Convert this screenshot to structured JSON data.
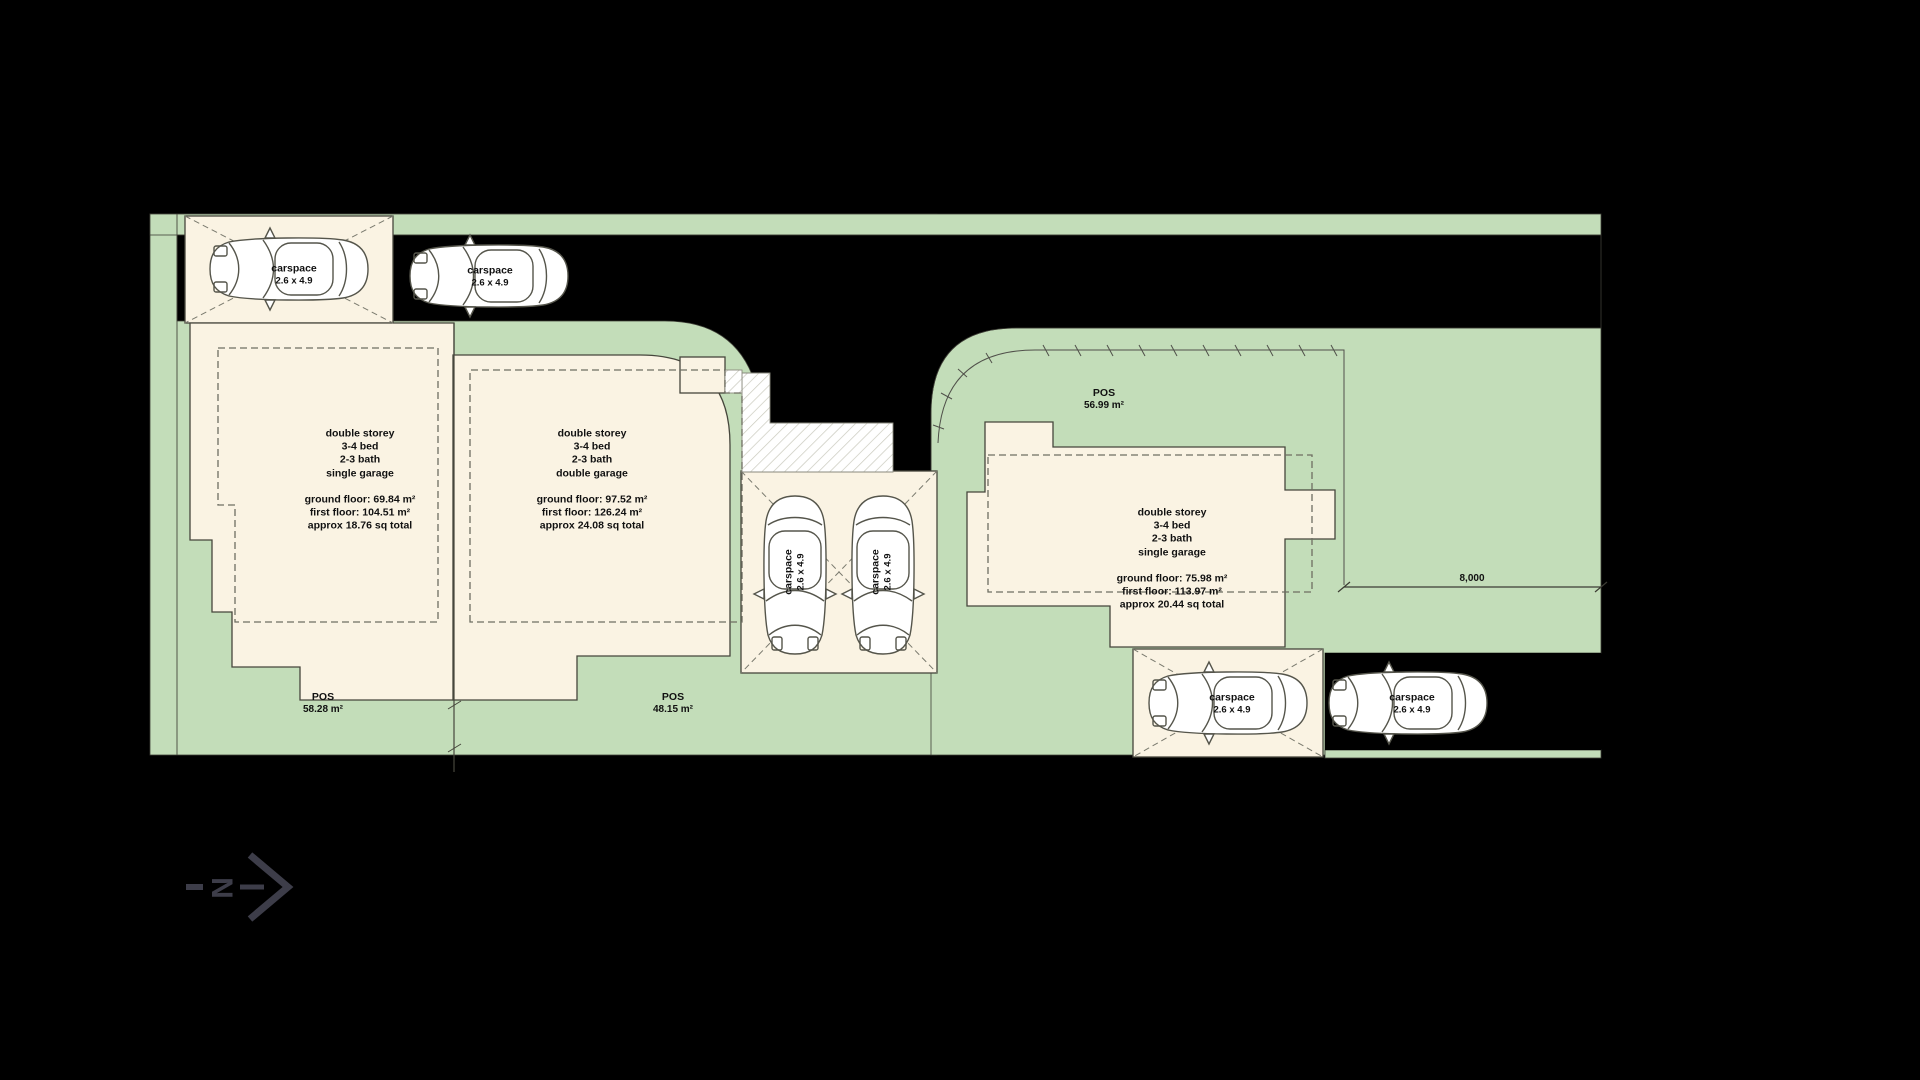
{
  "plan": {
    "carspaces": [
      {
        "name": "carspace",
        "size": "2.6 x 4.9"
      },
      {
        "name": "carspace",
        "size": "2.6 x 4.9"
      },
      {
        "name": "carspace",
        "size": "2.6 x 4.9"
      },
      {
        "name": "carspace",
        "size": "2.6 x 4.9"
      },
      {
        "name": "carspace",
        "size": "2.6 x 4.9"
      },
      {
        "name": "carspace",
        "size": "2.6 x 4.9"
      }
    ],
    "units": [
      {
        "desc": [
          "double storey",
          "3-4 bed",
          "2-3 bath",
          "single garage"
        ],
        "areas": [
          "ground floor: 69.84 m²",
          "first floor: 104.51 m²",
          "approx 18.76 sq total"
        ]
      },
      {
        "desc": [
          "double storey",
          "3-4 bed",
          "2-3 bath",
          "double garage"
        ],
        "areas": [
          "ground floor: 97.52 m²",
          "first floor: 126.24 m²",
          "approx 24.08 sq total"
        ]
      },
      {
        "desc": [
          "double storey",
          "3-4 bed",
          "2-3 bath",
          "single garage"
        ],
        "areas": [
          "ground floor: 75.98 m²",
          "first floor: 113.97 m²",
          "approx 20.44 sq total"
        ]
      }
    ],
    "pos_areas": [
      {
        "label": "POS",
        "area": "56.99 m²"
      },
      {
        "label": "POS",
        "area": "58.28 m²"
      },
      {
        "label": "POS",
        "area": "48.15 m²"
      }
    ],
    "dimension": {
      "value": "8,000"
    },
    "north": {
      "label": "N"
    }
  },
  "colors": {
    "background": "#000000",
    "grass": "#c3ddb9",
    "lot_fill": "#faf3e3",
    "outline": "#46463c",
    "dash": "#6e6e62",
    "car_fill": "#ffffff",
    "text": "#111111",
    "north_arrow": "#3d3d49"
  }
}
